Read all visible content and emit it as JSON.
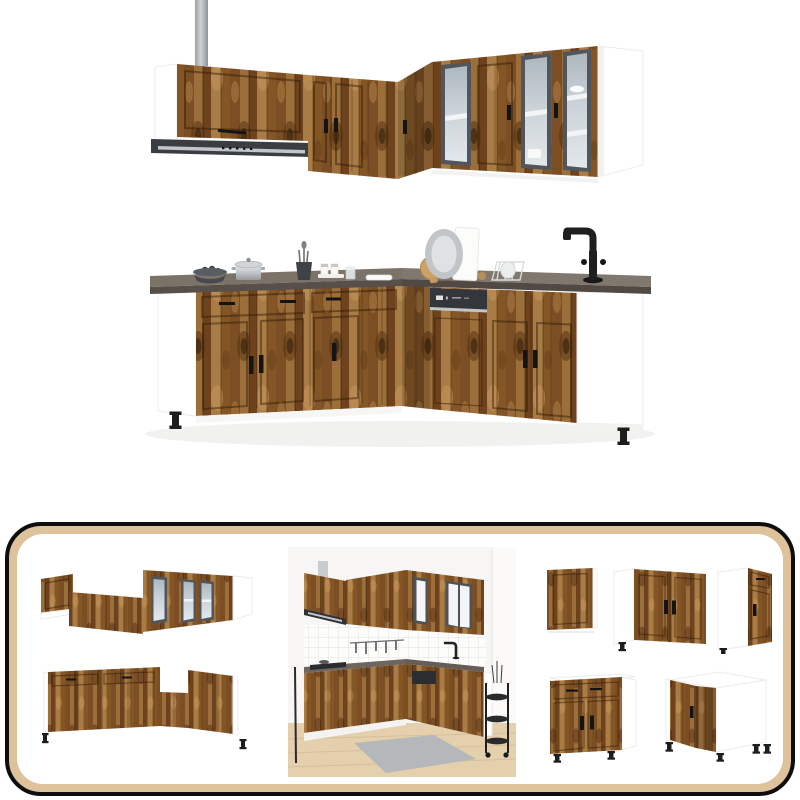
{
  "colors": {
    "page_bg": "#ffffff",
    "wood_light": "#a87c44",
    "wood_mid": "#8a5a2c",
    "wood_dark": "#6e421d",
    "wood_deep": "#53300f",
    "wood_seam": "#2f1905",
    "worktop_top": "#7b7268",
    "worktop_front": "#57504a",
    "carcass_white": "#ffffff",
    "carcass_edge": "#ececec",
    "hood_body": "#3a3d42",
    "appliance_panel": "#33363b",
    "silver": "#c3c6c9",
    "duct_light": "#cfd3d6",
    "duct_dark": "#91989e",
    "glass_frame": "#50565c",
    "glass_top": "#aeb8c0",
    "glass_bottom": "#e2e7ea",
    "handle_black": "#141414",
    "leg_black": "#1d1d1d",
    "frame_border": "#0e0e0e",
    "frame_band": "#dec29c",
    "photo_wall": "#f7f6f4",
    "photo_floor": "#e4d0ac",
    "photo_rug": "#b4b8bb",
    "photo_tile_grout": "#e3e1de"
  },
  "scene": {
    "top_label": "wall cabinet set, smoked oak, L-shaped, with range hood and glass doors",
    "middle_label": "base cabinet set with worktop, black faucet, dishwasher and kitchen accessories",
    "gallery_label": "product gallery panel",
    "gallery_items": [
      "wall cabinet set reverse angle",
      "base cabinet set reverse angle",
      "kitchen room scene",
      "wall cabinet",
      "sink base cabinet",
      "drawer base cabinet",
      "base cabinet with drawer",
      "corner base cabinet"
    ]
  }
}
